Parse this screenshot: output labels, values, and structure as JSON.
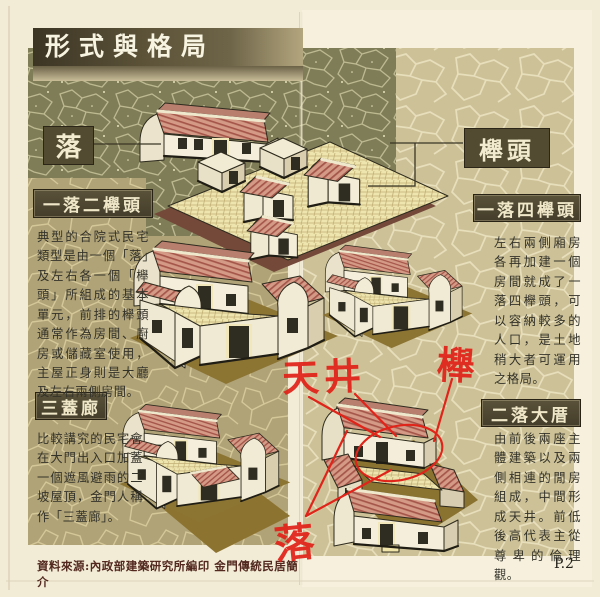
{
  "page": {
    "title": "形式與格局",
    "page_number": "P.2",
    "source": "資料來源:內政部建築研究所編印  金門傳統民居簡介"
  },
  "diagram_labels": {
    "luo": "落",
    "jutou": "櫸頭"
  },
  "sections": [
    {
      "heading": "一落二櫸頭",
      "body": "典型的合院式民宅類型是由一個「落」及左右各一個「櫸頭」所組成的基本單元，前排的櫸頭通常作為房間、廚房或儲藏室使用，主屋正身則是大廳及左右兩側房間。"
    },
    {
      "heading": "一落四櫸頭",
      "body": "左右兩側廂房各再加建一個房間就成了一落四櫸頭，可以容納較多的人口，是土地稍大者可運用之格局。"
    },
    {
      "heading": "三蓋廊",
      "body": "比較講究的民宅會在大門出入口加蓋一個遮風避雨的二坡屋頂，金門人稱作「三蓋廊」。"
    },
    {
      "heading": "二落大厝",
      "body": "由前後兩座主體建築以及兩側相連的閒房組成，中間形成天井。前低後高代表主從尊卑的倫理觀。"
    }
  ],
  "annotations": {
    "tianjing": "天井",
    "ju": "櫸",
    "luo": "落"
  },
  "colors": {
    "accent_red": "#e0241a",
    "olive_panel": "#7f7d57",
    "khaki_panel": "#b0a377",
    "tan_panel": "#cdc197",
    "heading_bar": "#4e4733",
    "roof": "#d49a86",
    "roof_stripe": "#a5564a",
    "ground_shadow": "#8c7433"
  }
}
